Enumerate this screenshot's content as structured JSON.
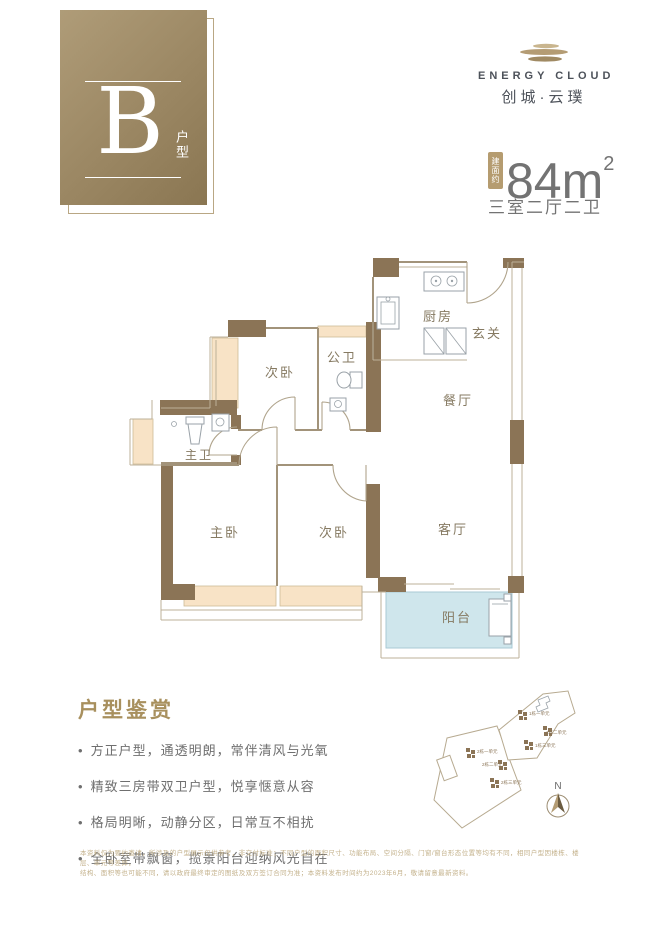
{
  "badge": {
    "letter": "B",
    "label": "户型"
  },
  "logo": {
    "name_en": "ENERGY CLOUD",
    "name_cn": "创城·云璞"
  },
  "area": {
    "tag": "建面约",
    "value": "84",
    "unit": "m",
    "sup": "2",
    "layout": "三室二厅二卫"
  },
  "floorplan": {
    "rooms": {
      "bedroom_top": "次卧",
      "bath_public": "公卫",
      "kitchen": "厨房",
      "foyer": "玄关",
      "dining": "餐厅",
      "bath_master": "主卫",
      "bedroom_master": "主卧",
      "bedroom_second": "次卧",
      "living": "客厅",
      "balcony": "阳台"
    }
  },
  "highlights": {
    "title": "户型鉴赏",
    "items": [
      "方正户型，通透明朗，常伴清风与光氧",
      "精致三房带双卫户型，悦享惬意从容",
      "格局明晰，动静分区，日常互不相扰",
      "全卧室带飘窗，揽景阳台迎纳风光自在"
    ]
  },
  "siteplan": {
    "north": "N",
    "units": [
      "2栋一单元",
      "2栋二单元",
      "2栋三单元",
      "1栋一单元",
      "1栋二单元",
      "1栋三单元"
    ]
  },
  "disclaimer": {
    "line1": "本资料仅为要约邀请，所涉及的户型展示仅供参考，非交付标准；不同户型的面积尺寸、功能布局、空间分隔、门窗/窗台形态位置等均有不同，相同户型因楼栋、楼层、单元等差异，",
    "line2": "结构、面积等也可能不同，请以政府最终审定的图纸及双方签订合同为准；本资料发布时间约为2023年6月，敬请留意最新资料。"
  },
  "colors": {
    "gold": "#9b8763",
    "wall": "#8b7456",
    "bay": "#f8e3c6",
    "balcony": "#cfe6ec",
    "accent_text": "#a8905e",
    "gray_text": "#6f6f6f"
  }
}
